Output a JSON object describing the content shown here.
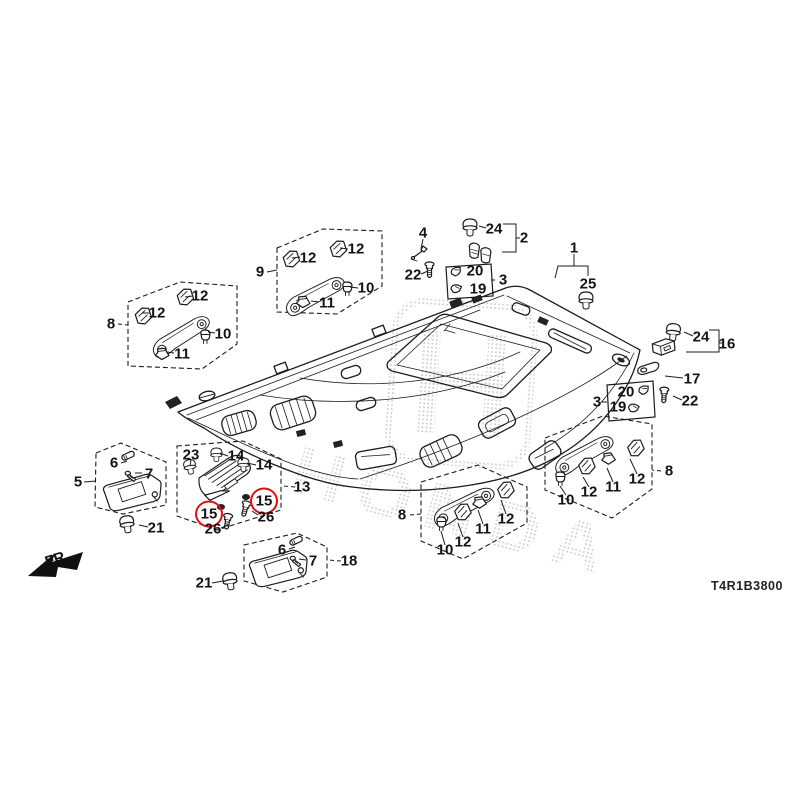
{
  "diagram": {
    "code": "T4R1B3800",
    "fr_label": "FR.",
    "watermark_text": "HONDA",
    "colors": {
      "line_art": "#1c1c1c",
      "highlight_red": "#e01010",
      "watermark_gray": "#c8c8c8"
    },
    "callouts": [
      {
        "t": "8",
        "x": 111,
        "y": 324
      },
      {
        "t": "12",
        "x": 157,
        "y": 313
      },
      {
        "t": "12",
        "x": 200,
        "y": 296
      },
      {
        "t": "10",
        "x": 223,
        "y": 334
      },
      {
        "t": "11",
        "x": 182,
        "y": 354
      },
      {
        "t": "9",
        "x": 260,
        "y": 272
      },
      {
        "t": "12",
        "x": 308,
        "y": 258
      },
      {
        "t": "12",
        "x": 356,
        "y": 249
      },
      {
        "t": "10",
        "x": 366,
        "y": 288
      },
      {
        "t": "11",
        "x": 327,
        "y": 303
      },
      {
        "t": "4",
        "x": 423,
        "y": 233
      },
      {
        "t": "24",
        "x": 494,
        "y": 229
      },
      {
        "t": "2",
        "x": 524,
        "y": 238
      },
      {
        "t": "22",
        "x": 413,
        "y": 275
      },
      {
        "t": "20",
        "x": 475,
        "y": 271
      },
      {
        "t": "19",
        "x": 478,
        "y": 289
      },
      {
        "t": "3",
        "x": 503,
        "y": 280
      },
      {
        "t": "1",
        "x": 574,
        "y": 248
      },
      {
        "t": "25",
        "x": 588,
        "y": 284
      },
      {
        "t": "24",
        "x": 701,
        "y": 337
      },
      {
        "t": "16",
        "x": 727,
        "y": 344
      },
      {
        "t": "17",
        "x": 692,
        "y": 379
      },
      {
        "t": "3",
        "x": 597,
        "y": 402
      },
      {
        "t": "20",
        "x": 626,
        "y": 392
      },
      {
        "t": "19",
        "x": 618,
        "y": 407
      },
      {
        "t": "22",
        "x": 690,
        "y": 401
      },
      {
        "t": "5",
        "x": 78,
        "y": 482
      },
      {
        "t": "6",
        "x": 114,
        "y": 463
      },
      {
        "t": "7",
        "x": 149,
        "y": 474
      },
      {
        "t": "21",
        "x": 156,
        "y": 528
      },
      {
        "t": "23",
        "x": 191,
        "y": 455
      },
      {
        "t": "14",
        "x": 236,
        "y": 456
      },
      {
        "t": "14",
        "x": 264,
        "y": 465
      },
      {
        "t": "13",
        "x": 302,
        "y": 487
      },
      {
        "t": "15",
        "x": 209,
        "y": 514,
        "circled": true
      },
      {
        "t": "15",
        "x": 264,
        "y": 501,
        "circled": true
      },
      {
        "t": "26",
        "x": 266,
        "y": 517
      },
      {
        "t": "26",
        "x": 213,
        "y": 529
      },
      {
        "t": "6",
        "x": 282,
        "y": 550
      },
      {
        "t": "7",
        "x": 313,
        "y": 561
      },
      {
        "t": "18",
        "x": 349,
        "y": 561
      },
      {
        "t": "21",
        "x": 204,
        "y": 583
      },
      {
        "t": "8",
        "x": 402,
        "y": 515
      },
      {
        "t": "10",
        "x": 445,
        "y": 550
      },
      {
        "t": "12",
        "x": 463,
        "y": 542
      },
      {
        "t": "11",
        "x": 483,
        "y": 529
      },
      {
        "t": "12",
        "x": 506,
        "y": 519
      },
      {
        "t": "8",
        "x": 669,
        "y": 471
      },
      {
        "t": "10",
        "x": 566,
        "y": 500
      },
      {
        "t": "12",
        "x": 589,
        "y": 492
      },
      {
        "t": "11",
        "x": 613,
        "y": 487
      },
      {
        "t": "12",
        "x": 637,
        "y": 479
      }
    ]
  }
}
